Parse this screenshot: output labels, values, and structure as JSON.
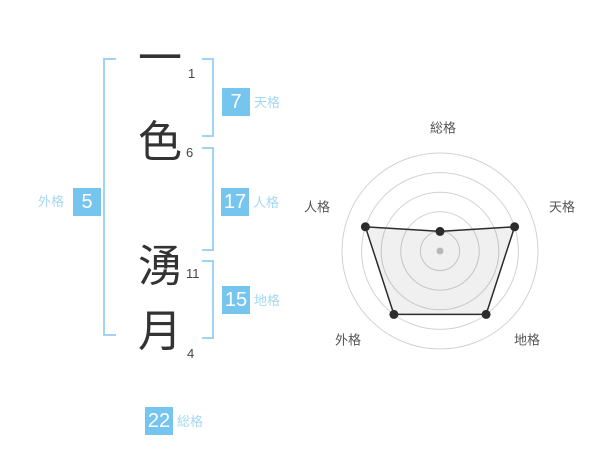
{
  "name_panel": {
    "characters": [
      {
        "char": "一",
        "strokes": "1"
      },
      {
        "char": "色",
        "strokes": "6"
      },
      {
        "char": "湧",
        "strokes": "11"
      },
      {
        "char": "月",
        "strokes": "4"
      }
    ],
    "kaku": [
      {
        "id": "tenkaku",
        "label": "天格",
        "value": "7"
      },
      {
        "id": "jinkaku",
        "label": "人格",
        "value": "17"
      },
      {
        "id": "chikaku",
        "label": "地格",
        "value": "15"
      },
      {
        "id": "gaikaku",
        "label": "外格",
        "value": "5"
      },
      {
        "id": "soukaku",
        "label": "総格",
        "value": "22"
      }
    ]
  },
  "chart_data": {
    "type": "radar",
    "axes": [
      "総格",
      "天格",
      "地格",
      "外格",
      "人格"
    ],
    "values": [
      1,
      4,
      4,
      4,
      4
    ],
    "scale_max": 5,
    "rings": 5,
    "grid": "concentric-circles",
    "legend": "none",
    "title": ""
  },
  "colors": {
    "box_blue": "#76c5ef",
    "label_blue": "#a5d8f3",
    "bracket_blue": "#9fd5f2",
    "ring_gray": "#d2d2d2",
    "polygon_stroke": "#2b2b2b",
    "polygon_fill": "rgba(0,0,0,0.06)",
    "marker_dark": "#2b2b2b",
    "center_dot": "#b9b9b9",
    "axis_label_gray": "#555555"
  }
}
